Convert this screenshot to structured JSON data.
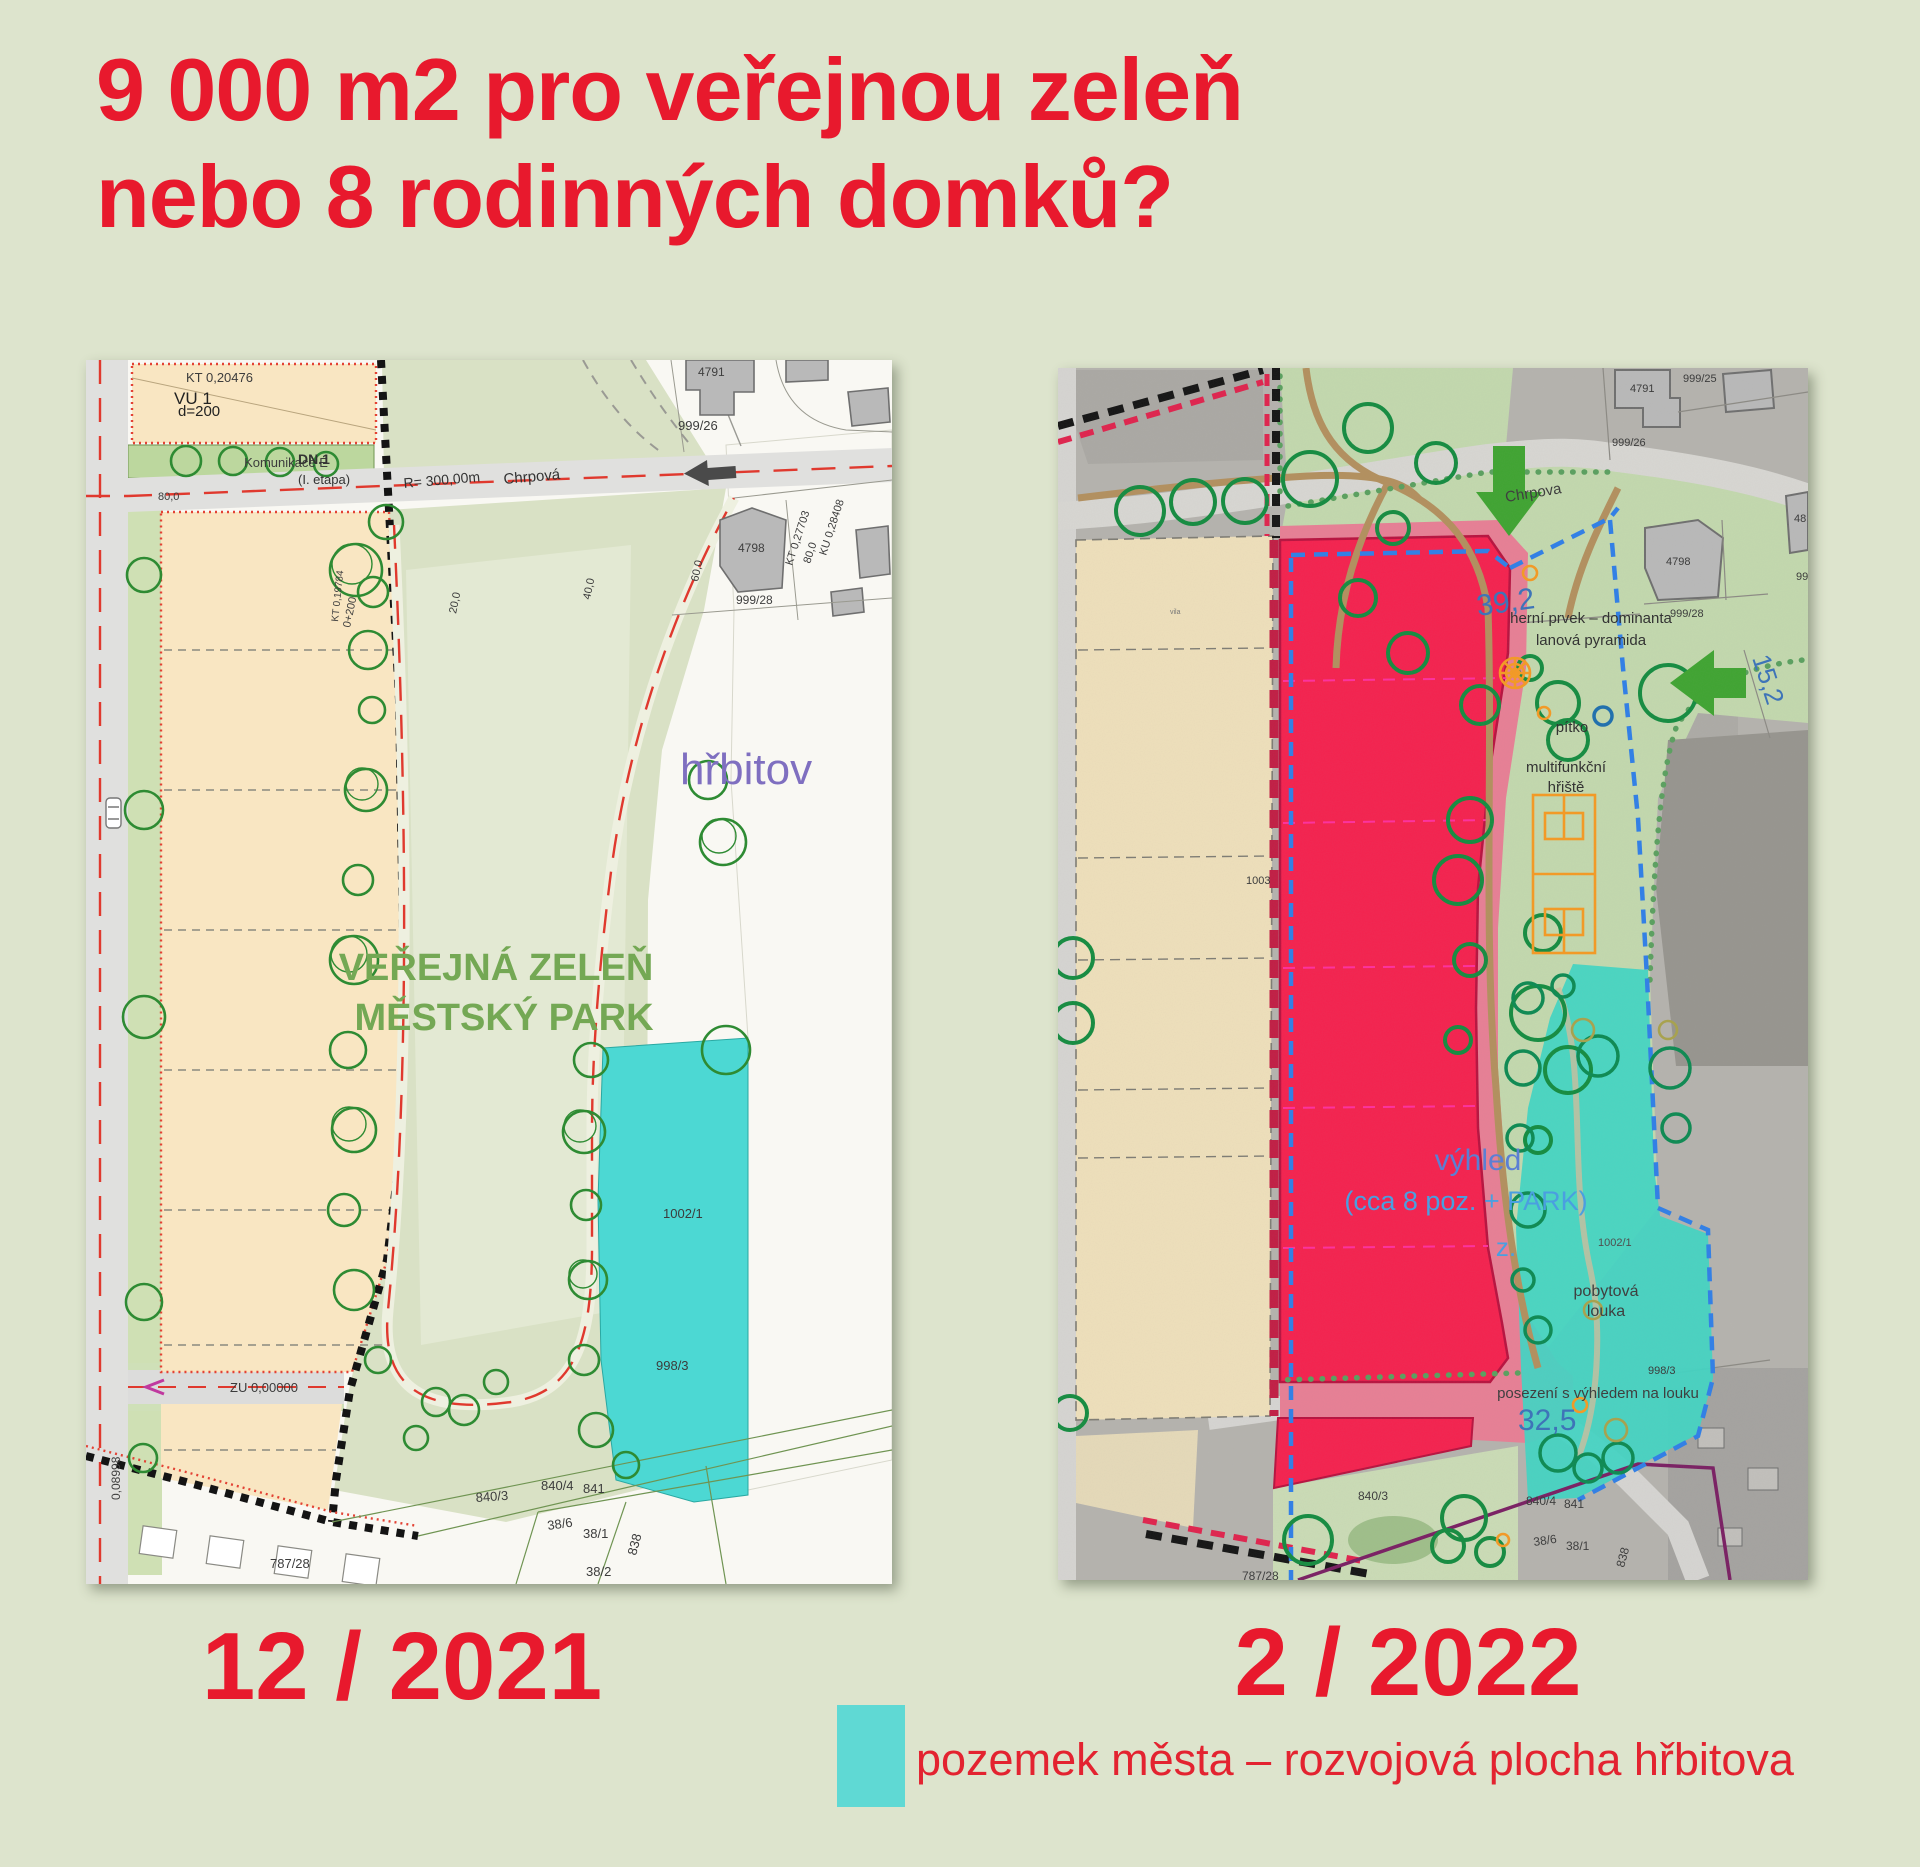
{
  "page": {
    "title_line1": "9 000 m2 pro veřejnou zeleň",
    "title_line2": "nebo 8 rodinných domků?",
    "title_color": "#e8192d",
    "background": "#dde4cd"
  },
  "left_map": {
    "caption": "12 / 2021",
    "labels": {
      "kt_top": "KT 0,20476",
      "vu1": "VU 1",
      "d200": "d=200",
      "komunikace": "Komunikace E",
      "m80_top": "80,0",
      "dn1": "DN.1",
      "etapa": "(I. etapa)",
      "r300": "R= 300,00m",
      "chrpova": "Chrpová",
      "p4791": "4791",
      "p999_26": "999/26",
      "p4798": "4798",
      "p999_28": "999/28",
      "ku028408": "KU 0,28408",
      "kt027703": "KT 0,27703",
      "m80": "80,0",
      "m60": "60,0",
      "m40": "40,0",
      "m20": "20,0",
      "km0200": "0+200",
      "kt019784": "KT 0,19784",
      "hrbitov": "hřbitov",
      "park_line1": "VEŘEJNÁ ZELEŇ",
      "park_line2": "MĚSTSKÝ PARK",
      "p1002_1": "1002/1",
      "zu": "ZU 0,00000",
      "v008998": "0,08998",
      "p998_3": "998/3",
      "p840_3": "840/3",
      "p840_4": "840/4",
      "p841": "841",
      "p38_6": "38/6",
      "p38_1": "38/1",
      "p38_2": "38/2",
      "p838": "838",
      "p787_28": "787/28"
    },
    "colors": {
      "park_text": "#74a854",
      "hrbitov_text": "#7f6fc0",
      "cyan_area": "#4cd8d3",
      "parcel_beige": "#f9e6c2"
    }
  },
  "right_map": {
    "caption": "2 / 2022",
    "labels": {
      "p999_25": "999/25",
      "p4791": "4791",
      "p999_26": "999/26",
      "chrpova": "Chrpova",
      "p4798": "4798",
      "p999_28": "999/28",
      "p48_partial": "48",
      "p99_partial": "99",
      "d39_2": "39,2",
      "herni1": "herní prvek – dominanta",
      "herni2": "lanová pyramida",
      "pitko": "pítko",
      "multi1": "multifunkční",
      "multi2": "hřiště",
      "d15_2": "15,2",
      "p1003": "1003",
      "vila": "vila",
      "vyhled": "výhled",
      "cca": "(cca 8 poz. + PARK)",
      "z": "z.",
      "p1002_1": "1002/1",
      "pobytova1": "pobytová",
      "pobytova2": "louka",
      "posezeni": "posezení s výhledem na louku",
      "d32_5": "32,5",
      "p998_3": "998/3",
      "p840_3": "840/3",
      "p840_4": "840/4",
      "p841": "841",
      "p38_6": "38/6",
      "p38_1": "38/1",
      "p838": "838",
      "p787_28": "787/28"
    },
    "colors": {
      "red_zone": "#f5214e",
      "cyan_area": "#41d5c4",
      "blue_dash": "#2f7fe8",
      "blue_text": "#3e74b8",
      "arrow_green": "#3fa431",
      "orange": "#f59a23"
    }
  },
  "legend": {
    "swatch_color": "#5fd9d4",
    "text": "pozemek města – rozvojová plocha hřbitova"
  }
}
